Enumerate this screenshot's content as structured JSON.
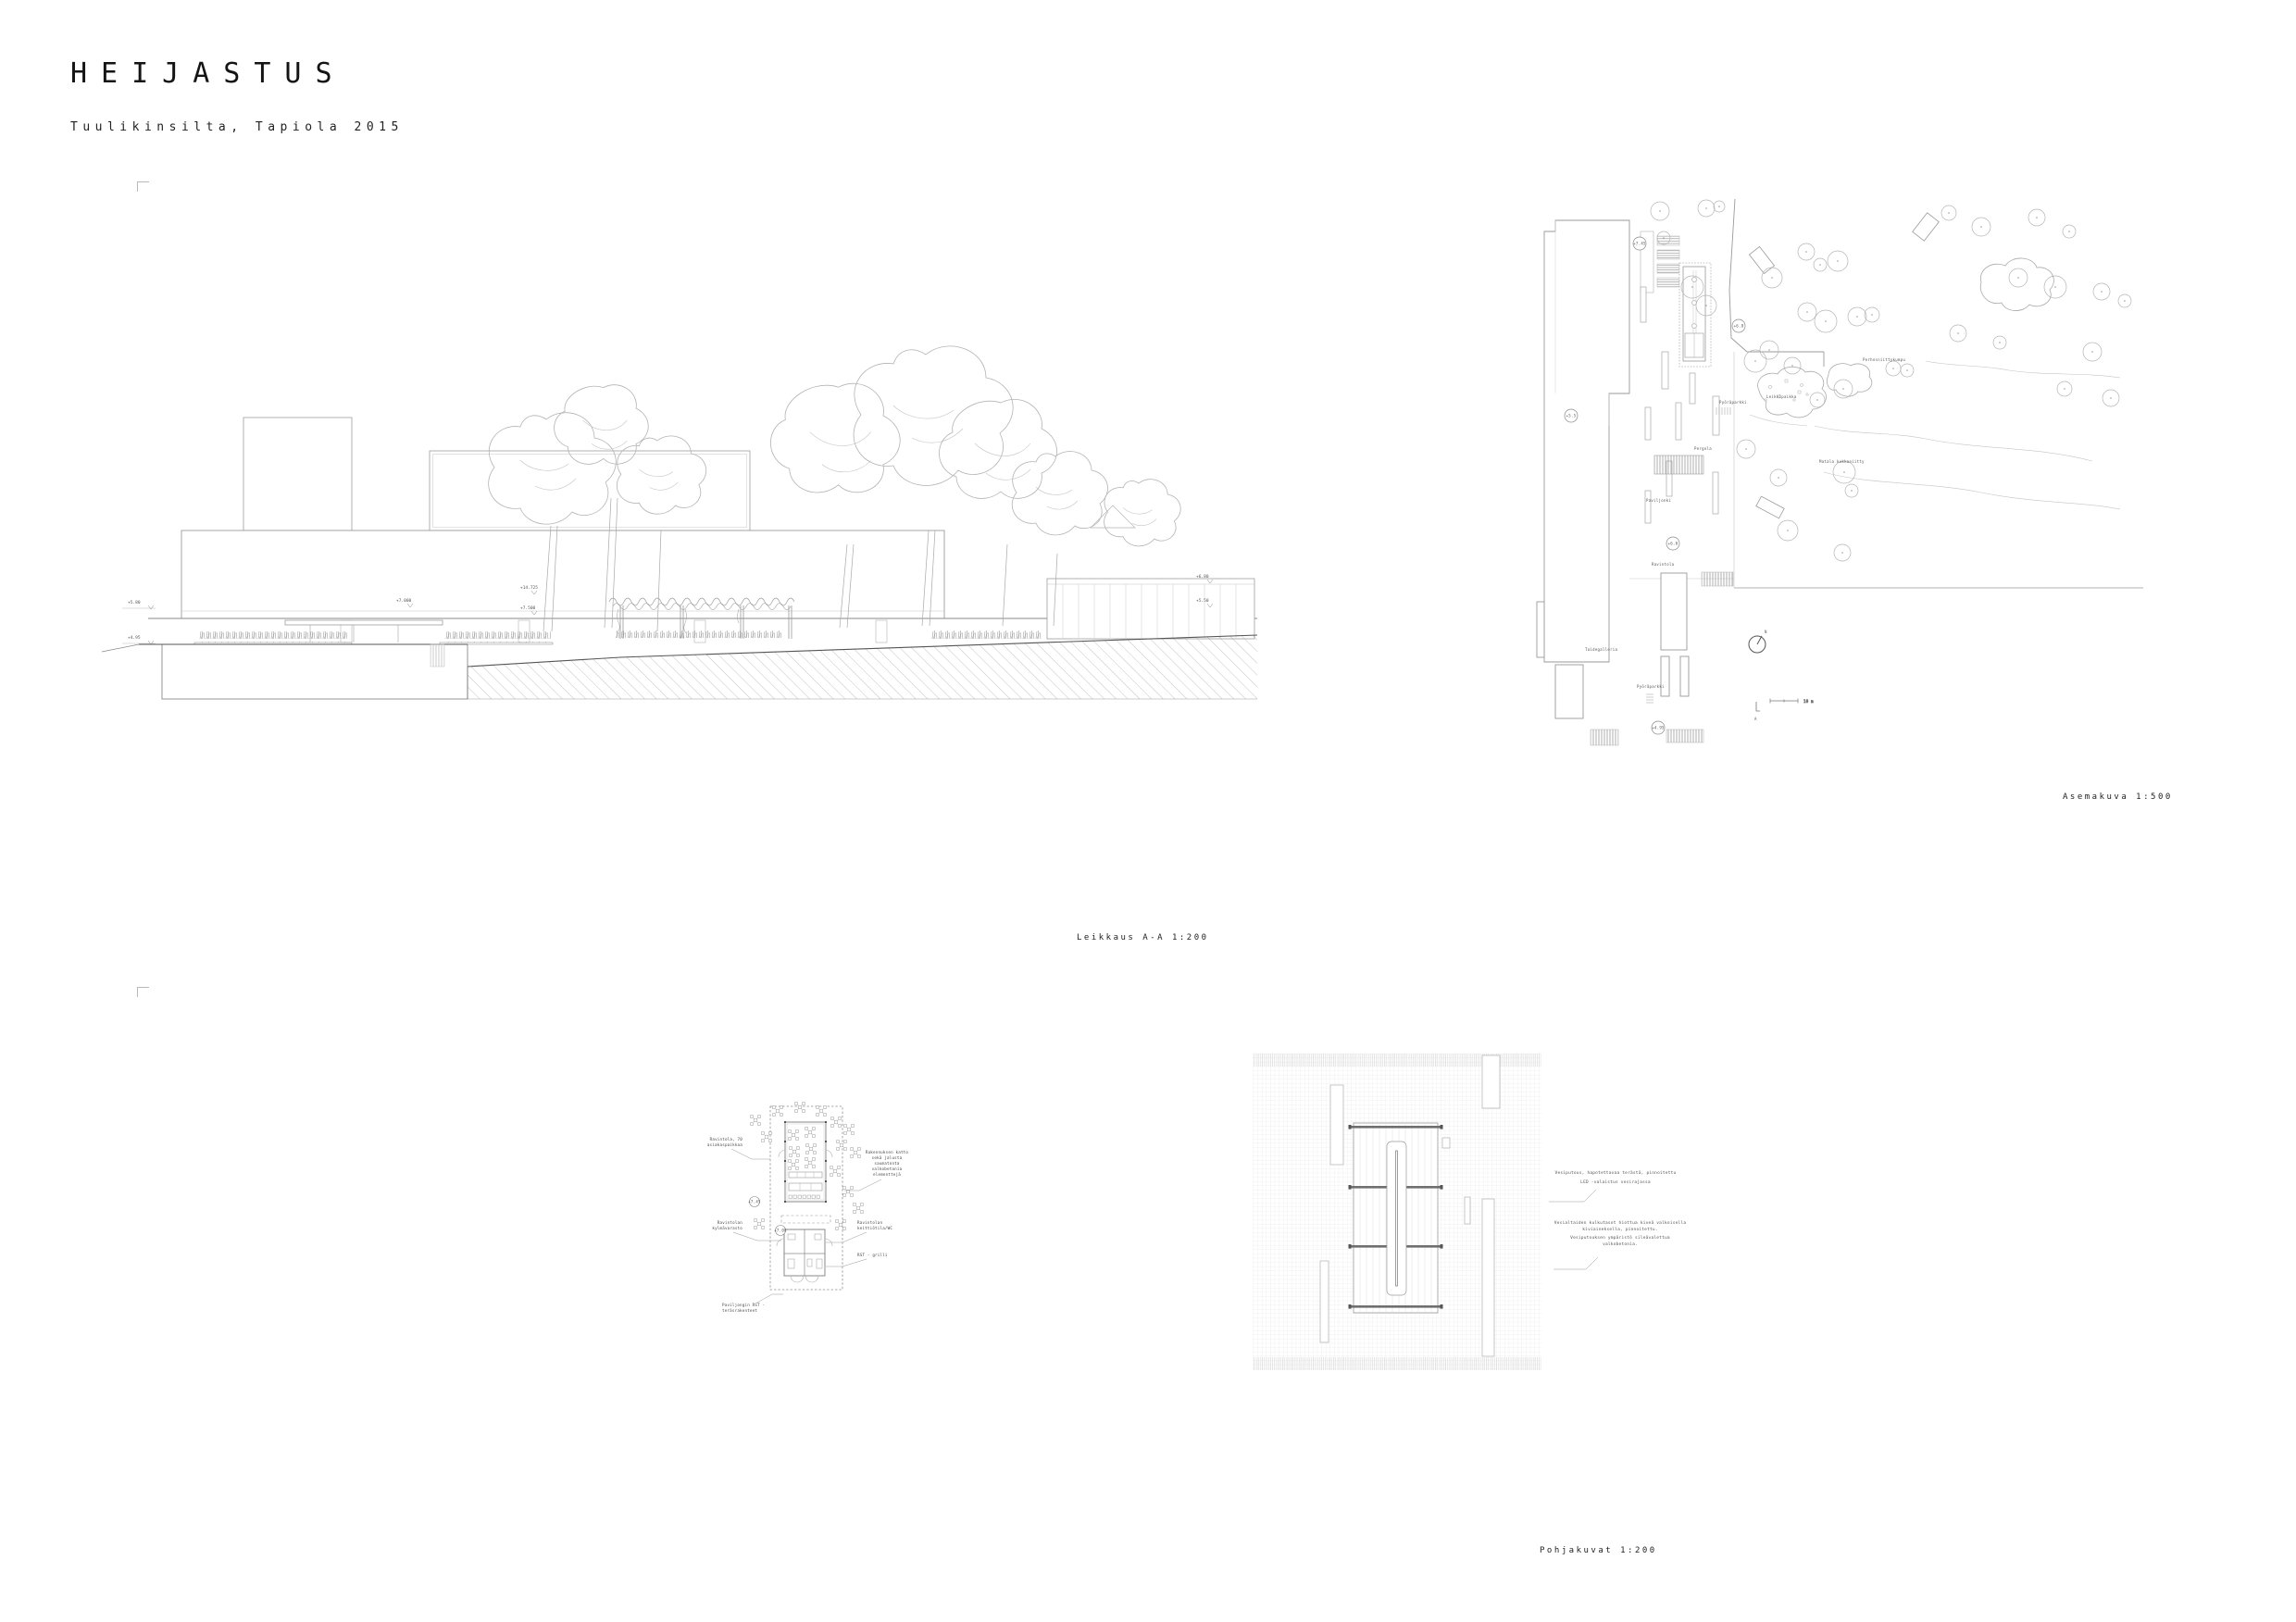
{
  "header": {
    "title": "HEIJASTUS",
    "subtitle": "Tuulikinsilta, Tapiola 2015"
  },
  "captions": {
    "section": "Leikkaus A-A 1:200",
    "siteplan": "Asemakuva 1:500",
    "floorplans": "Pohjakuvat 1:200"
  },
  "section": {
    "levels": [
      "+5.80",
      "+4.95",
      "+7.000",
      "+14.725",
      "+7.500",
      "+6.80",
      "+5.50"
    ]
  },
  "siteplan": {
    "labels": {
      "bike_top": "Pyöräparkki",
      "pergola": "Pergola",
      "pavilion": "Paviljonki",
      "restaurant": "Ravintola",
      "gallery": "Taidegalleria",
      "bike_bottom": "Pyöräparkki",
      "playground": "Leikkipaikka",
      "meadow": "Perhosniittykumpu",
      "flowerfield": "Matala kukkaniitty"
    },
    "elevations": [
      "+7.45",
      "+6.8",
      "+5.5",
      "+6.0",
      "+4.95"
    ],
    "north": "N",
    "scale": "10 m",
    "marker": "A"
  },
  "detail": {
    "callouts": {
      "seats1": "Ravintola, 70",
      "seats2": "asiakaspaikkaa",
      "roof1": "Rakennuksen katto",
      "roof2": "sekä jalusta",
      "roof3": "saumatonta",
      "roof4": "valkobetonia",
      "roof5": "elementtejä",
      "cold1": "Ravintolan",
      "cold2": "kylmävarasto",
      "kitchen1": "Ravintolan",
      "kitchen2": "keittiötila/WC",
      "grill": "RST - grilli",
      "frame1": "Paviljongin RST -",
      "frame2": "teräsrakenteet"
    },
    "elevations": [
      "+7.45",
      "+7.00"
    ]
  },
  "floorplan": {
    "callout1": [
      "Vesiputous, hapotettavaa terästä, pinnoitettu",
      "LED -valaistus vesirajassa"
    ],
    "callout2": [
      "Vesialtaiden kulkutasot hiottua kiveä valkoisella",
      "kiviaineksella, pinnoitettu.",
      "Vesiputouksen ympäristö sileävalettua",
      "valkobetonia."
    ]
  },
  "colors": {
    "line_light": "#aaaaaa",
    "line_dark": "#555555",
    "grid": "#dcdcdc",
    "text": "#222222"
  }
}
